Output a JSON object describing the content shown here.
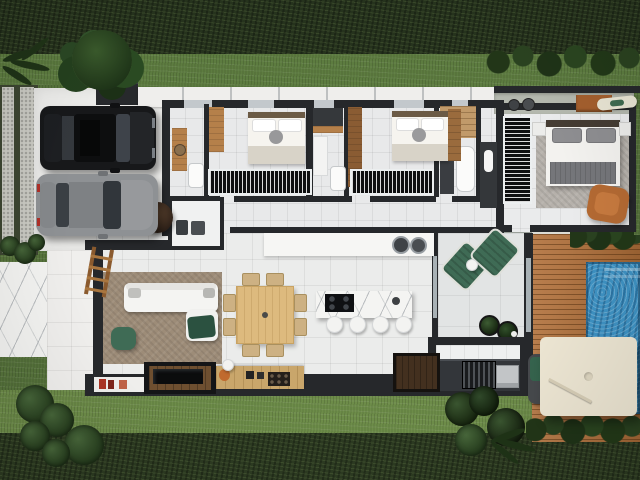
{
  "meta": {
    "type": "3d-floor-plan-render",
    "view": "top-down",
    "description": "Single-storey house render: carport with two cars, three-bedroom wing with bathrooms, laundry nook, master suite, open living-dining-kitchen, covered patio, outdoor barbecue kitchen, wooden deck with swimming pool and white parasol, lawns and hedges around"
  },
  "palette": {
    "hedge": "#26331d",
    "hedgeBottom": "#2c3a21",
    "grassTop": "#5d7c40",
    "grassSide": "#57743c",
    "grassBottom": "#6d8c49",
    "concreteStrip": "#c9c9c2",
    "stripBase": "#3c4531",
    "driveway": "#ececea",
    "walkway": "#f0efed",
    "marbleBase": "#f4f4f2",
    "floorBedroom": "#e8e9ea",
    "floorLiving": "#ebeceb",
    "floorPatio": "#e2e4e4",
    "floorMaster": "#eaebec",
    "wall": "#26282b",
    "eave": "#efeeec",
    "deck": "#b06f39",
    "pool": "#3e92c3",
    "wood": "#b5804a",
    "woodLight": "#ddba7e",
    "woodDark": "#43301f",
    "sofa": "#f4f4f2",
    "rugLiving": "#9d8c78",
    "rugMaster": "#b6b1ab",
    "greenCushion": "#2b5140",
    "greenChair": "#3f6b55",
    "orangeChair": "#b46a33",
    "counter": "#f6f6f4",
    "darkCounter": "#33363a",
    "canopy": "#ece5d2",
    "shelfConcrete": "#b4b8ae",
    "carBlack": "#17181a",
    "carGray": "#8e9194",
    "treeGreen": "#2c4424"
  },
  "scene": {
    "yard": [
      "top-hedge",
      "top-lawn",
      "shrub-row",
      "tree-over-driveway",
      "palm-plants",
      "street-strips",
      "marble-walkway",
      "bottom-lawn",
      "bottom-hedge",
      "bush-clusters",
      "ferns"
    ],
    "carport": {
      "vehicles": [
        "black-suv",
        "gray-sedan"
      ],
      "extras": [
        "gate-box"
      ]
    },
    "rooms": [
      {
        "id": "bathroom-1",
        "furniture": [
          "wood-vanity",
          "toilet"
        ]
      },
      {
        "id": "bedroom-1",
        "furniture": [
          "bed",
          "wood-desk",
          "slatted-wardrobe"
        ]
      },
      {
        "id": "bathroom-2",
        "furniture": [
          "vanity",
          "toilet",
          "dark-counter",
          "wood-shelf"
        ]
      },
      {
        "id": "bedroom-2",
        "furniture": [
          "bed",
          "slatted-wardrobe",
          "wood-closet"
        ]
      },
      {
        "id": "bathroom-3",
        "furniture": [
          "wood-shower-floor",
          "tub",
          "dark-vanity",
          "hall-cabinet"
        ]
      },
      {
        "id": "laundry-nook",
        "furniture": [
          "washer",
          "dryer"
        ]
      },
      {
        "id": "master-suite",
        "furniture": [
          "double-bed",
          "nightstands",
          "slatted-wardrobe",
          "rug",
          "leather-armchair",
          "decor-shelf-with-vases",
          "cabinet",
          "surfboard"
        ]
      },
      {
        "id": "living-room",
        "furniture": [
          "l-shaped-sofa",
          "rug",
          "green-pouf",
          "green-throw",
          "decor-ladder",
          "potted-tree",
          "tv-wall-unit",
          "book-shelf",
          "sideboard-with-lamp-and-wine-rack"
        ]
      },
      {
        "id": "dining-area",
        "furniture": [
          "square-wood-table",
          "eight-chairs"
        ]
      },
      {
        "id": "kitchen",
        "furniture": [
          "marble-island-with-cooktop",
          "four-stools",
          "back-counter-with-two-sinks"
        ]
      },
      {
        "id": "covered-patio",
        "furniture": [
          "two-green-loungers",
          "side-table",
          "potted-plants"
        ]
      },
      {
        "id": "outdoor-kitchen",
        "furniture": [
          "dark-counter",
          "grill",
          "steel-appliance",
          "dark-wood-table"
        ]
      }
    ],
    "pool_area": [
      "wood-deck",
      "swimming-pool",
      "pool-steps",
      "white-parasol",
      "deck-lounger-with-green-towel",
      "deck-hedge"
    ]
  }
}
